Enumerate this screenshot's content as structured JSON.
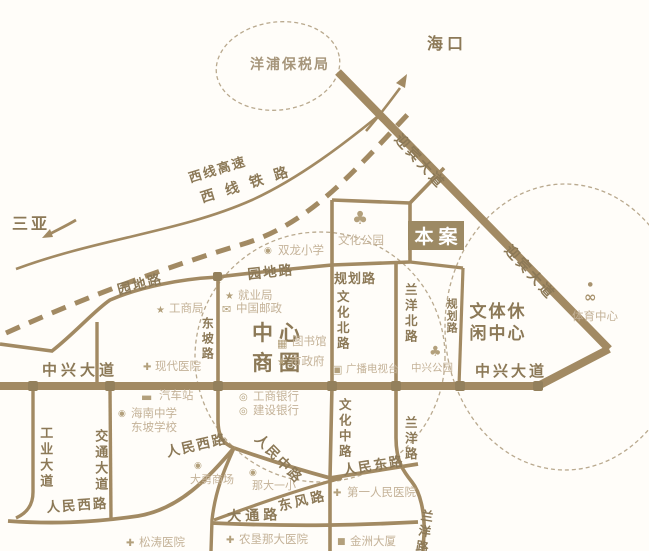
{
  "map": {
    "cities": {
      "sanya": "三亚",
      "haikou": "海口"
    },
    "zones": {
      "yangpu_bonded": "洋浦保税局",
      "central_business_line1": "中心",
      "central_business_line2": "商圈",
      "sports_leisure_line1": "文体休",
      "sports_leisure_line2": "闲中心"
    },
    "site": {
      "label": "本案"
    },
    "roads": {
      "xixian_expressway": "西线高速",
      "xixian_railway": "西 线 铁 路",
      "yingbin_avenue": "迎宾大道",
      "yuandi_road": "园地路",
      "planned_road": "规划路",
      "dongpo_road": "东坡路",
      "wenhua_north_road": "文化北路",
      "wenhua_middle_road": "文化中路",
      "lanyang_north_road": "兰洋北路",
      "lanyang_road": "兰洋路",
      "zhongxing_avenue": "中兴大道",
      "gongye_avenue": "工业大道",
      "jiaotong_avenue": "交通大道",
      "renmin_west_road": "人民西路",
      "renmin_middle_road": "人民中路",
      "renmin_east_road": "人民东路",
      "dongfeng_road": "东风路",
      "datong_road": "大通路"
    },
    "pois": {
      "wenhua_park": "文化公园",
      "shuanglong_primary": "双龙小学",
      "gongshang_bureau": "工商局",
      "jiuye_bureau": "就业局",
      "china_post": "中国邮政",
      "library": "图书馆",
      "city_hall": "市政府",
      "xiandai_hospital": "现代医院",
      "bus_station": "汽车站",
      "hainan_school_line1": "海南中学",
      "hainan_school_line2": "东坡学校",
      "icbc_bank": "工商银行",
      "ccb_bank": "建设银行",
      "tv_station": "广播电视台",
      "zhongxing_park": "中兴公园",
      "sports_center": "体育中心",
      "dayong_mall": "大勇商场",
      "nada_first_primary": "那大一小",
      "songtao_hospital": "松涛医院",
      "nongken_nada_hospital": "农垦那大医院",
      "first_people_hospital": "第一人民医院",
      "jinzhou_building": "金洲大厦"
    },
    "icons": {
      "star": "★",
      "cross": "✚",
      "dot": "◉",
      "square": "■",
      "mail": "✉",
      "building": "▦",
      "coin": "◎",
      "tv": "▣",
      "tree": "♣",
      "bus": "▬",
      "bicycle": "∞"
    },
    "colors": {
      "background": "#fffdf9",
      "road": "#a28a63",
      "label_dark": "#8c7957",
      "label_light": "#c4b298",
      "site_bg": "#9d8a64",
      "dash": "#b9a98e"
    }
  }
}
